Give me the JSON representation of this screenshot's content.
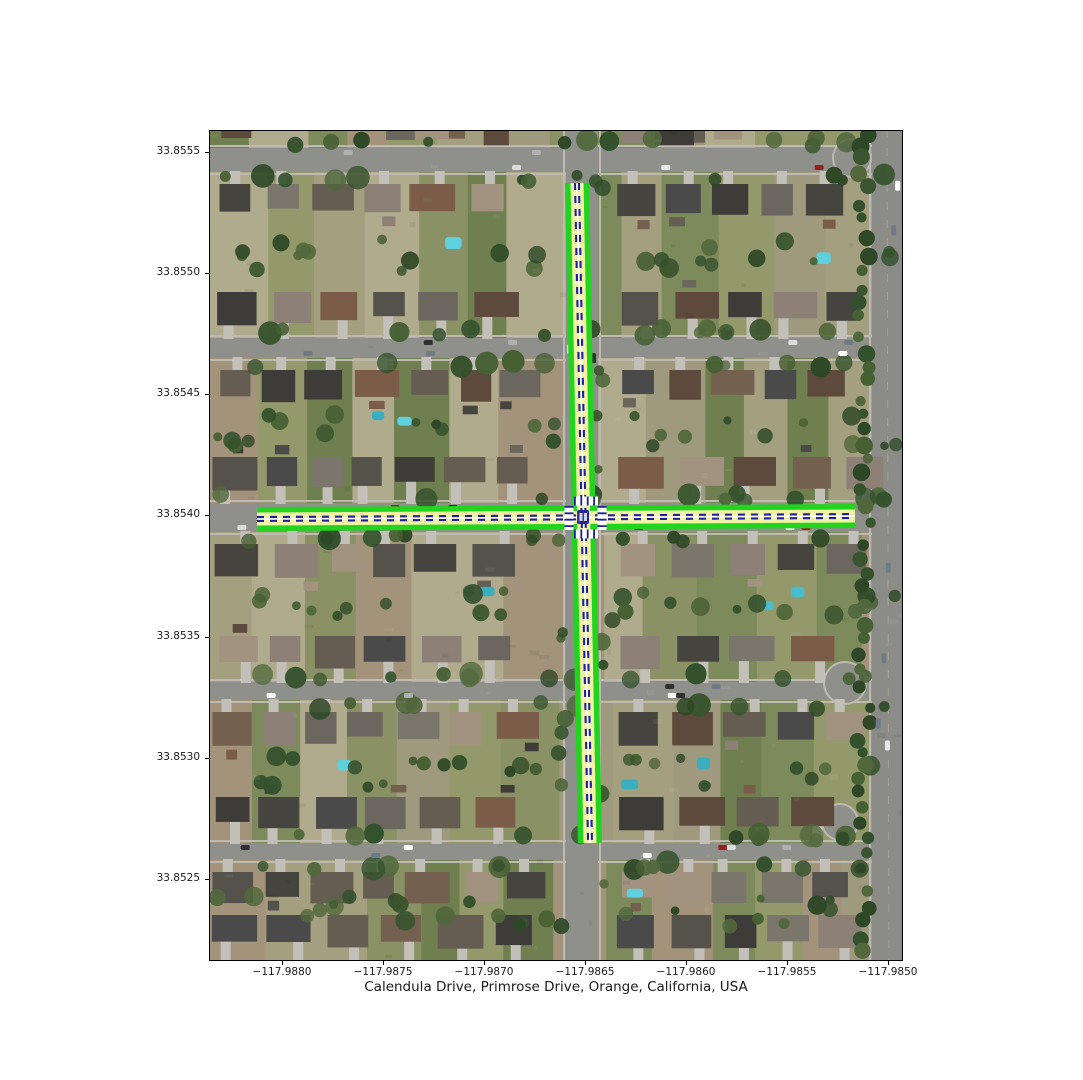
{
  "figure": {
    "title": "Calendula Drive, Primrose Drive, Orange, California, USA",
    "x_axis": {
      "ticks": [
        "−117.9880",
        "−117.9875",
        "−117.9870",
        "−117.9865",
        "−117.9860",
        "−117.9855",
        "−117.9850"
      ]
    },
    "y_axis": {
      "ticks": [
        "33.8555",
        "33.8550",
        "33.8545",
        "33.8540",
        "33.8535",
        "33.8530",
        "33.8525"
      ]
    }
  },
  "route_overlay": {
    "edge_color": "#23d41e",
    "lane_color": "#f2f2a6",
    "centerline_color": "#1e1e96",
    "marking_color": "#ffffff"
  }
}
